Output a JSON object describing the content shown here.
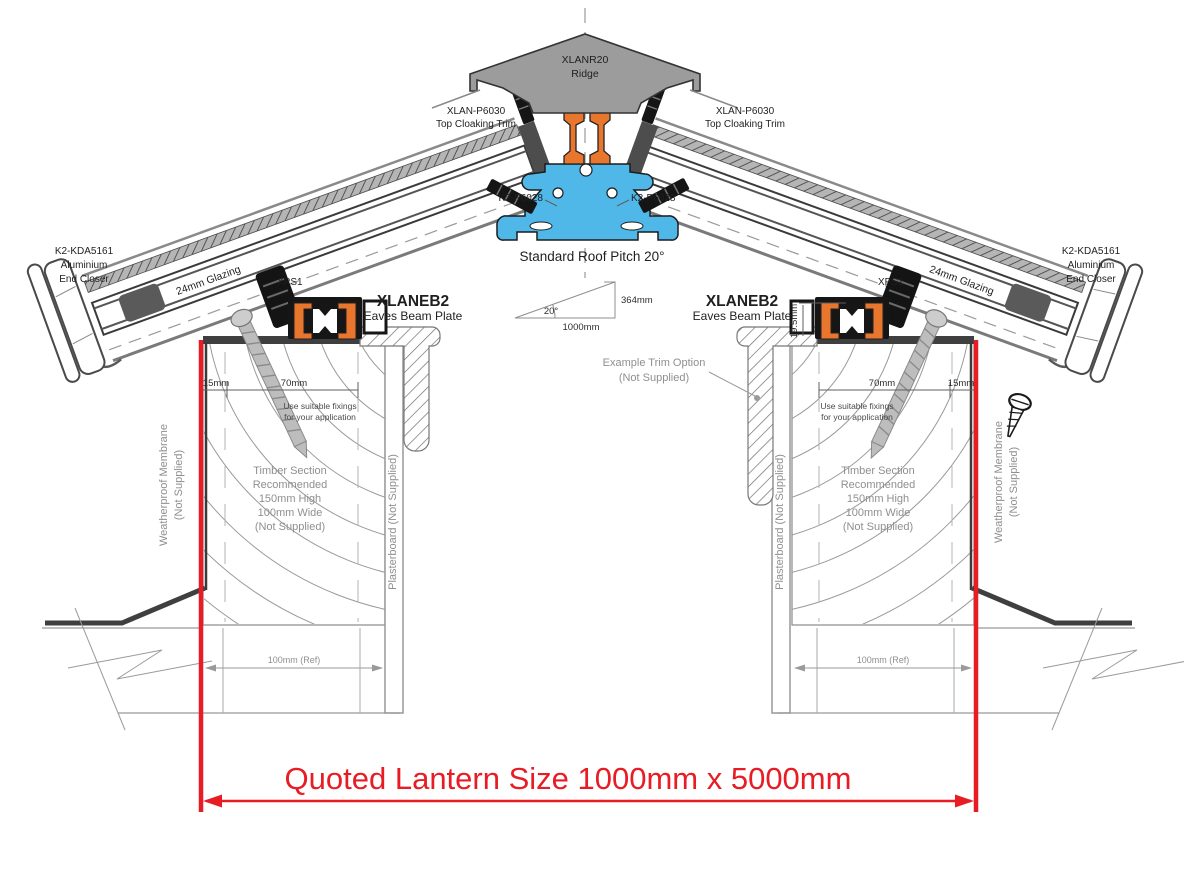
{
  "drawing": {
    "ridge": {
      "part": "XLANR20",
      "name": "Ridge"
    },
    "top_cloaking_trim": {
      "part": "XLAN-P6030",
      "name": "Top Cloaking Trim"
    },
    "ridge_base_part": "K2-P6028",
    "roof_pitch_label": "Standard Roof Pitch 20°",
    "pitch_triangle": {
      "angle": "20°",
      "rise": "364mm",
      "run": "1000mm"
    },
    "end_closer": {
      "part": "K2-KDA5161",
      "line2": "Aluminium",
      "line3": "End Closer"
    },
    "glazing_label": "24mm Glazing",
    "xps1_label": "XPS1",
    "eaves_beam": {
      "part": "XLANEB2",
      "name": "Eaves Beam Plate"
    },
    "dimensions": {
      "edge": "15mm",
      "fixing_zone": "70mm",
      "beam_height": "19.5mm",
      "wall_ref": "100mm (Ref)"
    },
    "fixing_note": [
      "Use suitable fixings",
      "for your application"
    ],
    "timber_note": [
      "Timber Section",
      "Recommended",
      "150mm High",
      "100mm Wide",
      "(Not Supplied)"
    ],
    "membrane_label": [
      "Weatherproof Membrane",
      "(Not Supplied)"
    ],
    "plasterboard_label": "Plasterboard (Not Supplied)",
    "example_trim_label": [
      "Example  Trim Option",
      "(Not Supplied)"
    ],
    "quoted_size": "Quoted Lantern Size 1000mm x 5000mm",
    "colors": {
      "accent_red": "#e81c24",
      "profile_orange": "#e8762c",
      "profile_blue": "#4fb8e8",
      "cap_grey": "#9c9c9c",
      "line_grey": "#8f8f8f"
    }
  }
}
